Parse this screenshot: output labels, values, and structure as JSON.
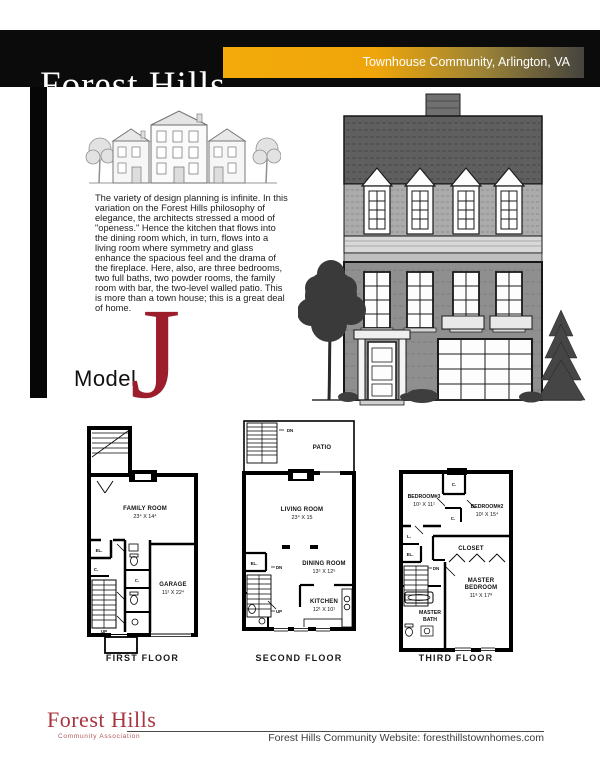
{
  "header": {
    "title": "Forest Hills",
    "banner": "Townhouse Community, Arlington, VA"
  },
  "intro": {
    "paragraph": "The variety of design planning is infinite. In this variation on the Forest Hills philosophy of elegance, the architects stressed a mood of \"openess.\" Hence the kitchen that flows into the dining room which, in turn, flows into a living room where symmetry and glass enhance the spacious feel and the drama of the fireplace. Here, also, are three bedrooms, two full baths, two powder rooms, the family room with bar, the two-level walled patio. This is more than a town house; this is a great deal of home.",
    "model_label": "Model",
    "model_letter": "J"
  },
  "plans": {
    "first": {
      "caption": "FIRST FLOOR",
      "family_room": "FAMILY ROOM",
      "family_room_dim": "23⁴ X 14⁴",
      "el": "EL.",
      "c1": "C.",
      "c2": "C.",
      "garage": "GARAGE",
      "garage_dim": "11² X 22⁴",
      "up": "UP"
    },
    "second": {
      "caption": "SECOND FLOOR",
      "dn1": "DN",
      "patio": "PATIO",
      "living_room": "LIVING ROOM",
      "living_room_dim": "23⁴ X 15",
      "el": "EL.",
      "dn2": "DN",
      "dining_room": "DINING ROOM",
      "dining_room_dim": "13⁵ X 12⁵",
      "up": "UP",
      "kitchen": "KITCHEN",
      "kitchen_dim": "12¹ X 10¹"
    },
    "third": {
      "caption": "THIRD FLOOR",
      "c1": "C.",
      "c2": "C.",
      "bedroom3": "BEDROOM#3",
      "bedroom3_dim": "10¹ X 11¹",
      "bedroom2": "BEDROOM#2",
      "bedroom2_dim": "10¹ X 15⁴",
      "l": "L.",
      "el": "EL.",
      "closet": "CLOSET",
      "dn": "DN",
      "master_l1": "MASTER",
      "master_l2": "BEDROOM",
      "master_dim": "11⁸ X 17⁸",
      "bath_l1": "MASTER",
      "bath_l2": "BATH"
    }
  },
  "footer": {
    "logo_title": "Forest Hills",
    "logo_subtitle": "Community Association",
    "website": "Forest Hills Community Website: foresthillstownhomes.com"
  },
  "colors": {
    "accent_red": "#9c1e2d",
    "logo_red": "#a8343f",
    "gold": "#f0a60a",
    "header_black": "#0b0b0b"
  }
}
